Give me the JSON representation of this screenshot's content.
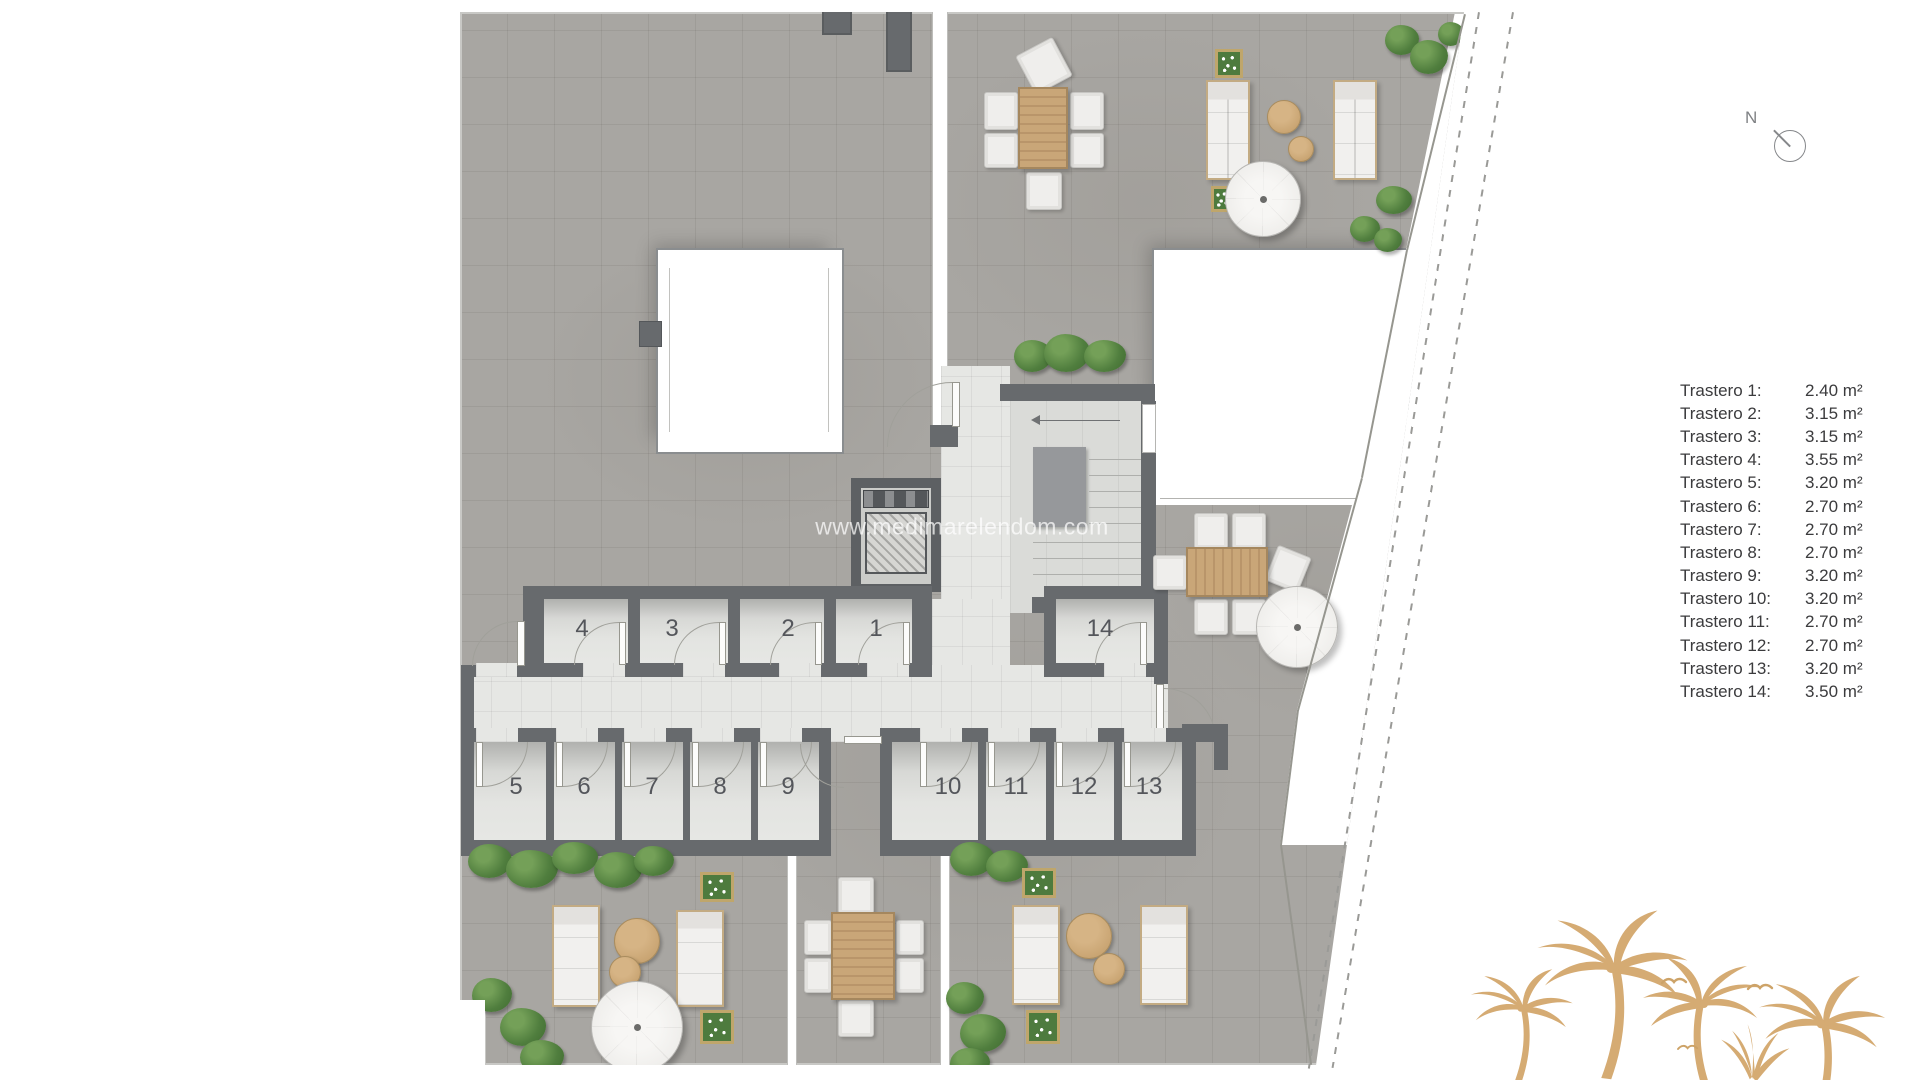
{
  "watermark": {
    "text": "www.medimarelendom.com"
  },
  "compass": {
    "label": "N"
  },
  "legend": {
    "items": [
      {
        "label": "Trastero 1:",
        "area": "2.40 m²"
      },
      {
        "label": "Trastero 2:",
        "area": "3.15 m²"
      },
      {
        "label": "Trastero 3:",
        "area": "3.15 m²"
      },
      {
        "label": "Trastero 4:",
        "area": "3.55 m²"
      },
      {
        "label": "Trastero 5:",
        "area": "3.20 m²"
      },
      {
        "label": "Trastero 6:",
        "area": "2.70 m²"
      },
      {
        "label": "Trastero 7:",
        "area": "2.70 m²"
      },
      {
        "label": "Trastero 8:",
        "area": "2.70 m²"
      },
      {
        "label": "Trastero 9:",
        "area": "3.20 m²"
      },
      {
        "label": "Trastero 10:",
        "area": "3.20 m²"
      },
      {
        "label": "Trastero 11:",
        "area": "2.70 m²"
      },
      {
        "label": "Trastero 12:",
        "area": "2.70 m²"
      },
      {
        "label": "Trastero 13:",
        "area": "3.20 m²"
      },
      {
        "label": "Trastero 14:",
        "area": "3.50 m²"
      }
    ]
  },
  "units": {
    "numbers": [
      "1",
      "2",
      "3",
      "4",
      "5",
      "6",
      "7",
      "8",
      "9",
      "10",
      "11",
      "12",
      "13",
      "14"
    ]
  },
  "colors": {
    "terrace": "#a8a6a2",
    "wall": "#676a6d",
    "corridor_floor": "#e6e7e4",
    "room_white": "#ffffff",
    "wood": "#c3a074",
    "greenery": "#4e7c3c",
    "palm": "#d5ab73",
    "legend_text": "#3b3b3d"
  }
}
